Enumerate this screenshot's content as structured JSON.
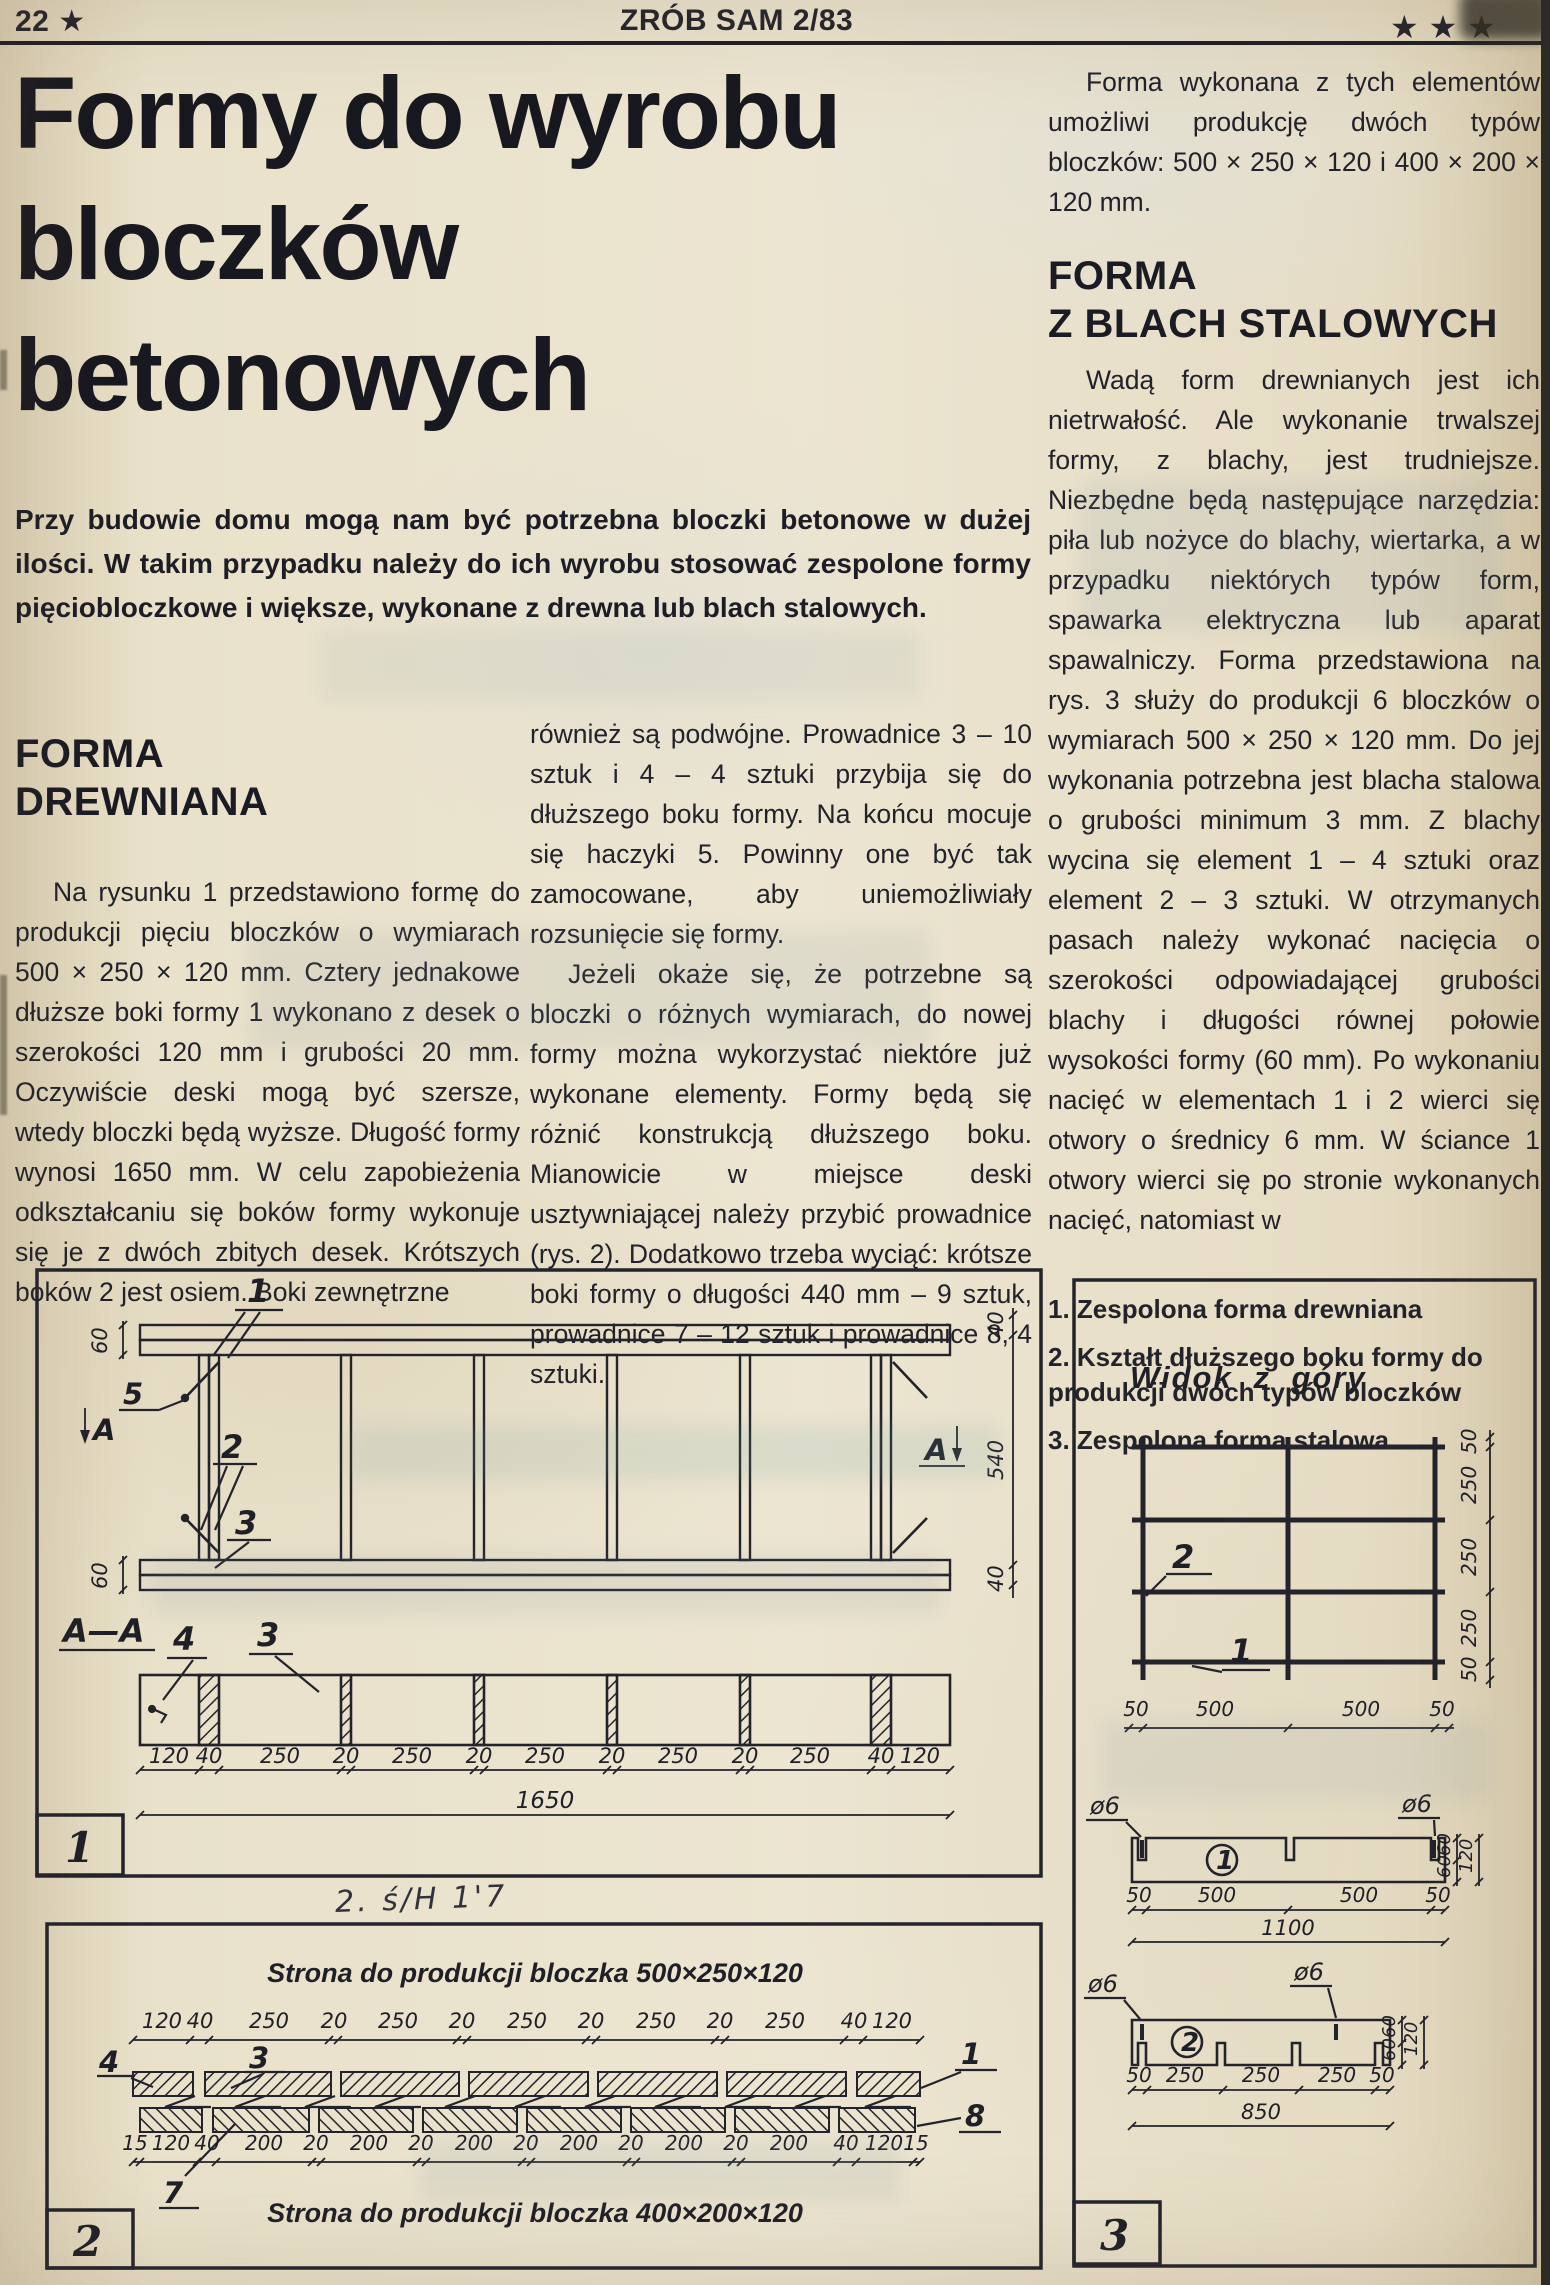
{
  "header": {
    "page_number": "22",
    "page_star": "★",
    "magazine": "ZRÓB SAM 2/83",
    "corner_stars": "★ ★ ★"
  },
  "headline": {
    "line1": "Formy do wyrobu",
    "line2": "bloczków",
    "line3": "betonowych"
  },
  "lead": "Przy budowie domu mogą nam być potrzebna bloczki betonowe w dużej ilości. W takim przypadku należy do ich wyrobu stosować zespolone formy pięciobloczkowe i większe, wykonane z drewna lub blach stalowych.",
  "left_column": {
    "heading1": "FORMA",
    "heading2": "DREWNIANA",
    "para": "Na rysunku 1 przedstawiono formę do produkcji pięciu bloczków o wymiarach 500 × 250 × 120 mm. Cztery jednakowe dłuższe boki formy 1 wykonano z desek o szerokości 120 mm i grubości 20 mm. Oczywiście deski mogą być szersze, wtedy bloczki będą wyższe. Długość formy wynosi 1650 mm. W celu zapobieżenia odkształcaniu się boków formy wykonuje się je z dwóch zbitych desek. Krótszych boków 2 jest osiem. Boki zewnętrzne"
  },
  "middle_column": {
    "para1": "również są podwójne. Prowadnice 3 – 10 sztuk i 4 – 4 sztuki przybija się do dłuższego boku formy. Na końcu mocuje się haczyki 5. Powinny one być tak zamocowane, aby uniemożliwiały rozsunięcie się formy.",
    "para2": "Jeżeli okaże się, że potrzebne są bloczki o różnych wymiarach, do nowej formy można wykorzystać niektóre już wykonane elementy. Formy będą się różnić konstrukcją dłuższego boku. Mianowicie w miejsce deski usztywniającej należy przybić prowadnice (rys. 2). Dodatkowo trzeba wyciąć: krótsze boki formy o długości 440 mm – 9 sztuk, prowadnice 7 – 12 sztuk i prowadnice 8, 4 sztuki."
  },
  "right_column": {
    "para1": "Forma wykonana z tych elementów umożliwi produkcję dwóch typów bloczków: 500 × 250 × 120 i 400 × 200 × 120 mm.",
    "heading1": "FORMA",
    "heading2": "Z BLACH STALOWYCH",
    "para2": "Wadą form drewnianych jest ich nietrwałość. Ale wykonanie trwalszej formy, z blachy, jest trudniejsze. Niezbędne będą następujące narzędzia: piła lub nożyce do blachy, wiertarka, a w przypadku niektórych typów form, spawarka elektryczna lub aparat spawalniczy. Forma przedstawiona na rys. 3 służy do produkcji 6 bloczków o wymiarach 500 × 250 × 120 mm. Do jej wykonania potrzebna jest blacha stalowa o grubości minimum 3 mm. Z blachy wycina się element 1 – 4 sztuki oraz element 2 – 3 sztuki. W otrzymanych pasach należy wykonać nacięcia o szerokości odpowiadającej grubości blachy i długości równej połowie wysokości formy (60 mm). Po wykonaniu nacięć w elementach 1 i 2 wierci się otwory o średnicy 6 mm. W ściance 1 otwory wierci się po stronie wykonanych nacięć, natomiast w",
    "captions": [
      "1. Zespolona forma drewniana",
      "2. Kształt dłuższego boku formy do produkcji dwóch typów bloczków",
      "3. Zespolona forma stalowa"
    ]
  },
  "handwriting": "2. ś/H 1'7",
  "fig1": {
    "number": "1",
    "n1": "1",
    "n5": "5",
    "n2": "2",
    "n3": "3",
    "a": "A",
    "dim60": "60",
    "right40": "40",
    "right540": "540",
    "section": "A—A",
    "n4": "4",
    "n3s": "3",
    "chain": [
      "120",
      "40",
      "250",
      "20",
      "250",
      "20",
      "250",
      "20",
      "250",
      "20",
      "250",
      "40",
      "120"
    ],
    "total": "1650"
  },
  "fig2": {
    "number": "2",
    "caption_top": "Strona do produkcji bloczka 500×250×120",
    "caption_bottom": "Strona do produkcji bloczka 400×200×120",
    "chain_top": [
      "120",
      "40",
      "250",
      "20",
      "250",
      "20",
      "250",
      "20",
      "250",
      "20",
      "250",
      "40",
      "120"
    ],
    "chain_bottom": [
      "15",
      "120",
      "40",
      "200",
      "20",
      "200",
      "20",
      "200",
      "20",
      "200",
      "20",
      "200",
      "20",
      "200",
      "40",
      "120",
      "15"
    ],
    "n4": "4",
    "n3": "3",
    "n7": "7",
    "n1": "1",
    "n8": "8"
  },
  "fig3": {
    "number": "3",
    "heading": "Widok z góry",
    "n2": "2",
    "n1": "1",
    "rchain": [
      "50",
      "250",
      "250",
      "250",
      "50"
    ],
    "bchain": [
      "50",
      "500",
      "500",
      "50"
    ],
    "hole": "ø6",
    "d60": "60",
    "d120": "120",
    "e1badge": "1",
    "e1chain": [
      "50",
      "500",
      "500",
      "50"
    ],
    "e1total": "1100",
    "e2badge": "2",
    "e2chain": [
      "50",
      "250",
      "250",
      "250",
      "50"
    ],
    "e2total": "850"
  }
}
